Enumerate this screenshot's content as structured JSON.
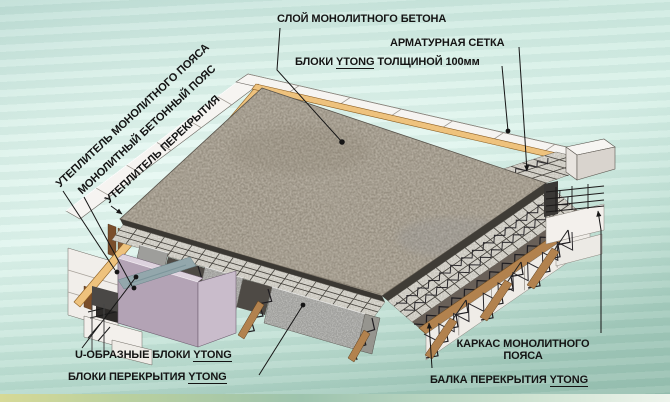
{
  "labels": {
    "concrete_layer": "СЛОЙ МОНОЛИТНОГО БЕТОНА",
    "rebar_mesh": "АРМАТУРНАЯ СЕТКА",
    "blocks100": {
      "pre": "БЛОКИ ",
      "ytong": "YTONG",
      "post": " ТОЛЩИНОЙ 100мм"
    },
    "belt_insulation": "УТЕПЛИТЕЛЬ МОНОЛИТНОГО ПОЯСА",
    "concrete_belt": "МОНОЛИТНЫЙ БЕТОННЫЙ ПОЯС",
    "floor_insulation": "УТЕПЛИТЕЛЬ ПЕРЕКРЫТИЯ",
    "u_blocks": {
      "pre": "U-ОБРАЗНЫЕ БЛОКИ ",
      "ytong": "YTONG"
    },
    "floor_blocks": {
      "pre": "БЛОКИ ПЕРЕКРЫТИЯ ",
      "ytong": "YTONG"
    },
    "belt_frame_line1": "КАРКАС МОНОЛИТНОГО",
    "belt_frame_line2": "ПОЯСА",
    "floor_beam": {
      "pre": "БАЛКА ПЕРЕКРЫТИЯ ",
      "ytong": "YTONG"
    }
  },
  "colors": {
    "background_teal": "#cfeae1",
    "concrete_base": "#90887a",
    "ytong_white": "#f6f4f1",
    "mesh_strip": "#c8c5bc",
    "block_gray": "#9e9e9b",
    "wood_beam": "#b2824e",
    "mauve_block": "#b3a3b5",
    "mauve_block_light": "#c9bccb",
    "orange_insulation": "#eec27d",
    "steel_dark": "#1f1d21",
    "label_text": "#141414"
  }
}
